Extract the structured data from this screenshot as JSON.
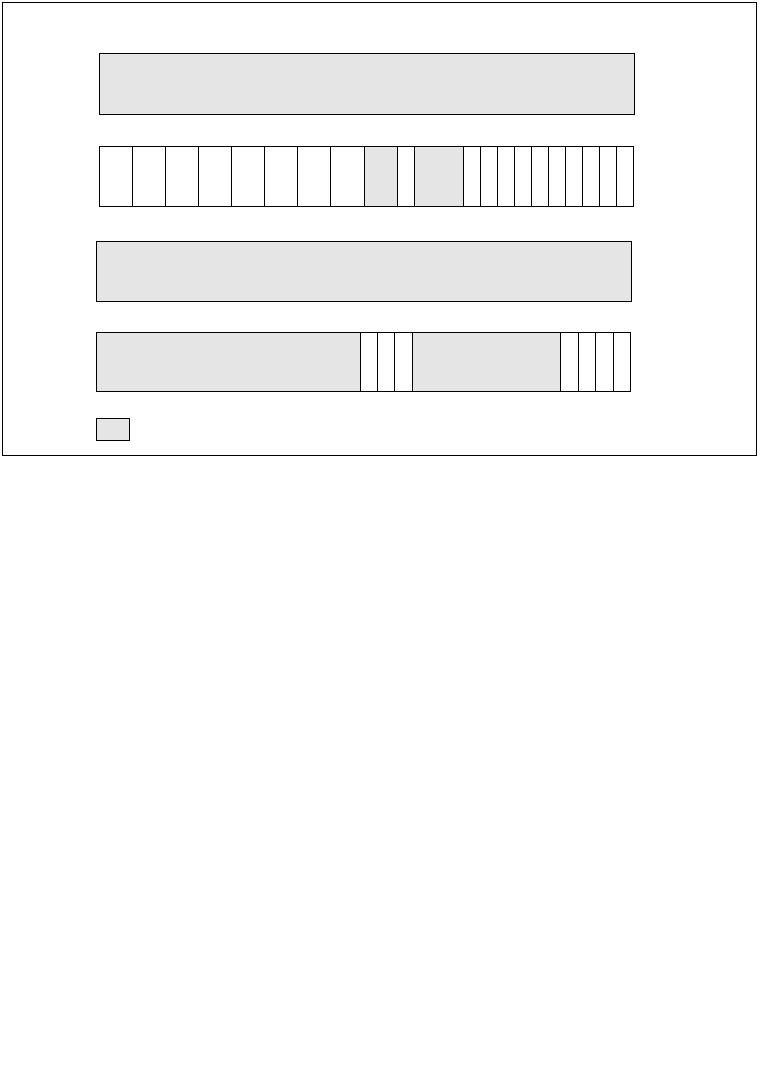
{
  "figure": {
    "type": "block-diagram",
    "description": "untitled drawing sheet with blank shaded blocks and two 32-unit segmented field strips",
    "colors": {
      "background": "#ffffff",
      "stroke": "#000000",
      "shaded_fill": "#e5e5e5"
    },
    "rows": {
      "top_box": {
        "shaded": true
      },
      "bit_strip": {
        "total_units": 32,
        "cells": [
          {
            "units": 2,
            "shaded": false
          },
          {
            "units": 2,
            "shaded": false
          },
          {
            "units": 2,
            "shaded": false
          },
          {
            "units": 2,
            "shaded": false
          },
          {
            "units": 2,
            "shaded": false
          },
          {
            "units": 2,
            "shaded": false
          },
          {
            "units": 2,
            "shaded": false
          },
          {
            "units": 2,
            "shaded": false
          },
          {
            "units": 2,
            "shaded": true
          },
          {
            "units": 1,
            "shaded": false
          },
          {
            "units": 3,
            "shaded": true
          },
          {
            "units": 1,
            "shaded": false
          },
          {
            "units": 1,
            "shaded": false
          },
          {
            "units": 1,
            "shaded": false
          },
          {
            "units": 1,
            "shaded": false
          },
          {
            "units": 1,
            "shaded": false
          },
          {
            "units": 1,
            "shaded": false
          },
          {
            "units": 1,
            "shaded": false
          },
          {
            "units": 1,
            "shaded": false
          },
          {
            "units": 1,
            "shaded": false
          },
          {
            "units": 1,
            "shaded": false
          }
        ]
      },
      "mid_box": {
        "shaded": true
      },
      "field_bar": {
        "total_units": 32,
        "cells": [
          {
            "units": 16,
            "shaded": true
          },
          {
            "units": 1,
            "shaded": false
          },
          {
            "units": 1,
            "shaded": false
          },
          {
            "units": 1,
            "shaded": false
          },
          {
            "units": 9,
            "shaded": true
          },
          {
            "units": 1,
            "shaded": false
          },
          {
            "units": 1,
            "shaded": false
          },
          {
            "units": 1,
            "shaded": false
          },
          {
            "units": 1,
            "shaded": false
          }
        ]
      },
      "legend_swatch": {
        "shaded": true
      }
    }
  }
}
